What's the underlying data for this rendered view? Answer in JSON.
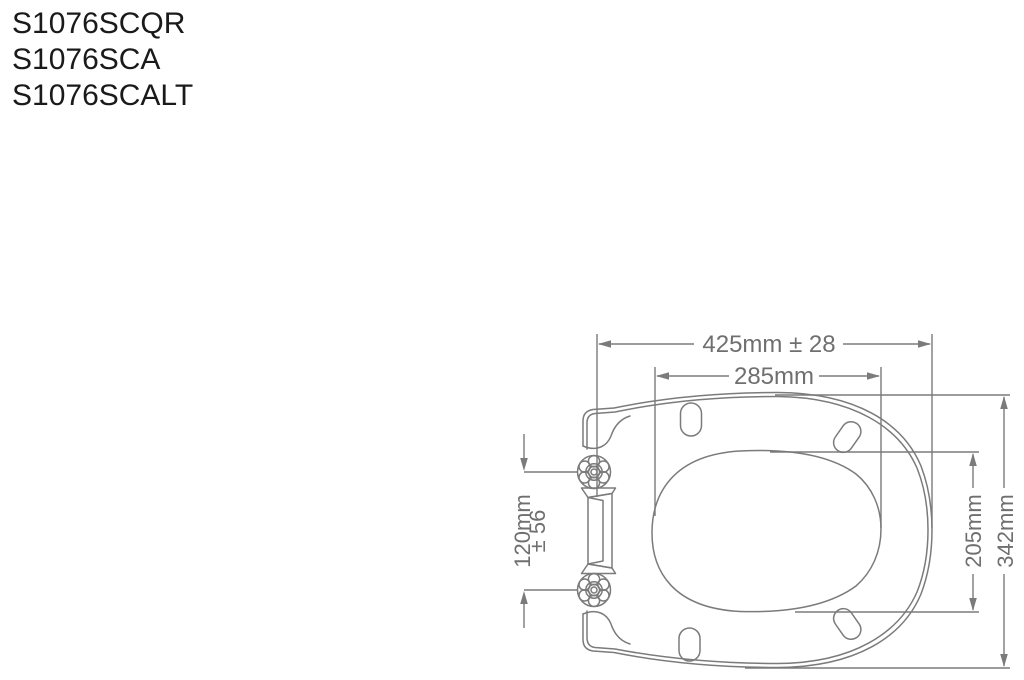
{
  "product_codes": [
    "S1076SCQR",
    "S1076SCA",
    "S1076SCALT"
  ],
  "diagram": {
    "labels": {
      "overall_width": "425mm ± 28",
      "inner_width": "285mm",
      "hinge_spacing_line1": "120mm",
      "hinge_spacing_line2": "± 56",
      "inner_depth": "205mm",
      "overall_depth": "342mm"
    },
    "colors": {
      "line": "#7b7b7b",
      "dimension_text": "#6f6f6f",
      "product_code_text": "#1a1a1a"
    }
  }
}
